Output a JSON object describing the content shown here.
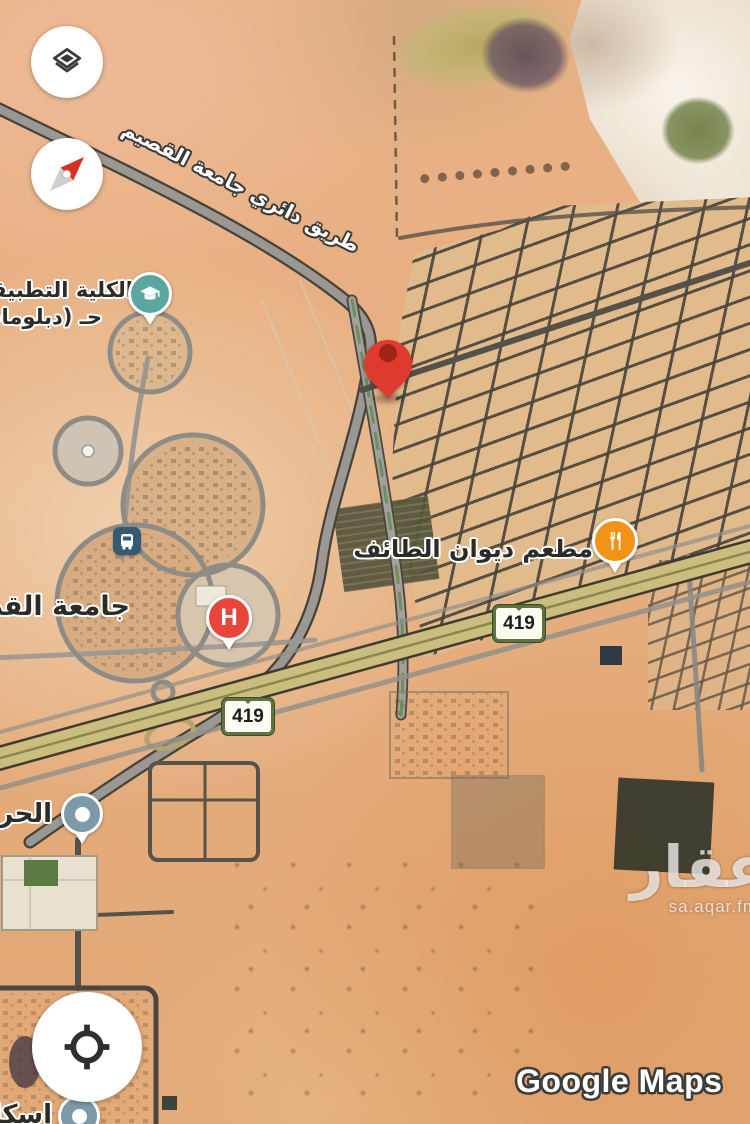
{
  "branding": {
    "logo_text": "Google Maps",
    "watermark_title": "عقار",
    "watermark_domain": "sa.aqar.fm"
  },
  "road_labels": {
    "ring_road": "طريق دائري جامعة القصيم"
  },
  "route_badges": {
    "badge_1": "419",
    "badge_2": "419"
  },
  "poi_labels": {
    "college_line1": "الكلية التطبيقية",
    "college_line2": "حـ (دبلومات)",
    "university": "جامعة القصيم",
    "restaurant": "مطعم ديوان الطائف",
    "guard": "الحرس",
    "housing": "إسكان",
    "hospital_letter": "H"
  },
  "markers": {
    "destination": {
      "type": "dropped-pin",
      "color": "#DE3A2F"
    },
    "education": {
      "type": "college",
      "color": "#5BA7A0"
    },
    "restaurant": {
      "type": "restaurant",
      "color": "#F09316"
    },
    "hospital": {
      "type": "hospital",
      "color": "#E8453C"
    },
    "transit": {
      "type": "bus-station",
      "color": "#375A73"
    },
    "guard": {
      "type": "place",
      "color": "#7E99A8"
    },
    "housing": {
      "type": "place",
      "color": "#7E99A8"
    }
  },
  "controls": {
    "layers_icon": "layers",
    "compass_icon": "compass",
    "my_location_icon": "crosshair"
  }
}
